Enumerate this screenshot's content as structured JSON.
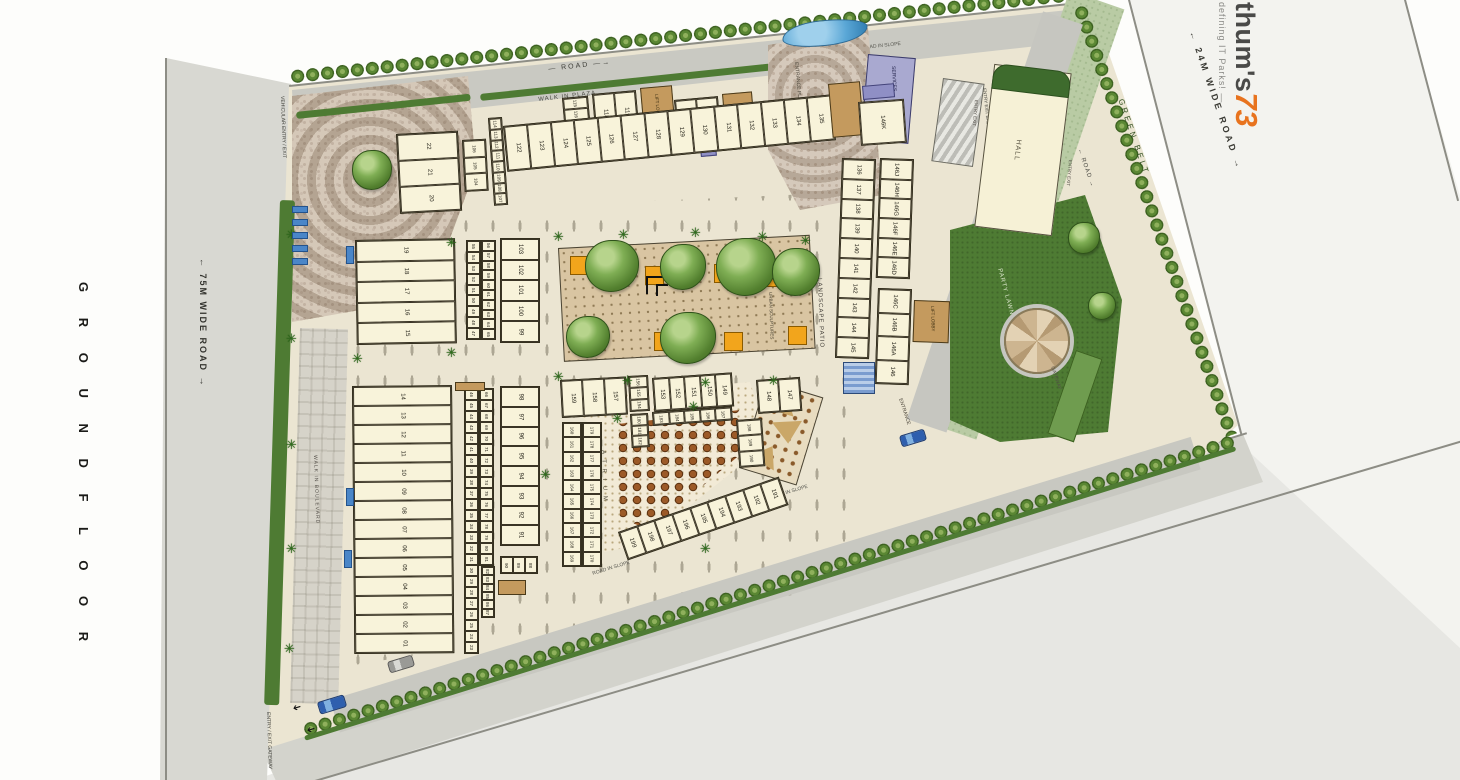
{
  "page": {
    "floor_title": "G R O U N D   F L O O R"
  },
  "brand": {
    "name_prefix": "thum's",
    "name_number": "73",
    "tagline": "defining IT Parks! —",
    "accent": "#e8731e"
  },
  "roads": {
    "left": "← 75M WIDE ROAD →",
    "right": "← 24M WIDE ROAD →",
    "bottom": "12M WIDE ROAD →",
    "top_inner": "— ROAD —→",
    "right_inner": "← ROAD →",
    "slope": "ROAD IN SLOPE",
    "green_belt": "GREEN BELT"
  },
  "labels": {
    "walk_in_plaza": "WALK IN PLAZA",
    "walk_in_boulevard": "WALK IN BOULEVARD",
    "patio": "PATIO",
    "vehicular_entry_exit": "VEHICULAR ENTRY / EXIT",
    "entry_exit_gateway": "ENTRY / EXIT GATEWAY",
    "entrance": "ENTRANCE",
    "entrance_plaza": "ENTRANCE PLAZA",
    "entry_exit_basement": "ENTRY EXIT BASEMENT",
    "entry_exit": "ENTRY EXIT",
    "services": "SERVICES",
    "hall": "HALL",
    "party_lawn": "PARTY LAWN",
    "landscape_patio": "LANDSCAPE PATIO",
    "urban_sculptures": "URBAN SCULPTURES",
    "atrium": "A T R I U M",
    "lift_lobby": "LIFT LOBBY",
    "gateway": "GATEWAY"
  },
  "units": {
    "col_22_20": [
      "22",
      "21",
      "20"
    ],
    "col_19_15": [
      "19",
      "18",
      "17",
      "16",
      "15"
    ],
    "col_14_01": [
      "14",
      "13",
      "12",
      "11",
      "10",
      "09",
      "08",
      "07",
      "06",
      "05",
      "04",
      "03",
      "02",
      "01"
    ],
    "strip_55_47": [
      "55",
      "54",
      "53",
      "52",
      "51",
      "50",
      "49",
      "48",
      "47"
    ],
    "strip_56_65": [
      "56",
      "57",
      "58",
      "59",
      "60",
      "61",
      "62",
      "63",
      "64",
      "65"
    ],
    "strip_46_23": [
      "46",
      "45",
      "44",
      "43",
      "42",
      "41",
      "40",
      "39",
      "38",
      "37",
      "36",
      "35",
      "34",
      "33",
      "32",
      "31",
      "30",
      "29",
      "28",
      "27",
      "26",
      "25",
      "24",
      "23"
    ],
    "strip_66_81": [
      "66",
      "67",
      "68",
      "69",
      "70",
      "71",
      "72",
      "73",
      "74",
      "75",
      "76",
      "77",
      "78",
      "79",
      "80",
      "81"
    ],
    "strip_82_87": [
      "82",
      "83",
      "84",
      "85",
      "86",
      "87"
    ],
    "col_103_99": [
      "103",
      "102",
      "101",
      "100",
      "99"
    ],
    "col_98_91": [
      "98",
      "97",
      "96",
      "95",
      "94",
      "93",
      "92",
      "91"
    ],
    "row_90_88": [
      "90",
      "89",
      "88"
    ],
    "stack_106_104": [
      "106",
      "105",
      "104"
    ],
    "strip_114_107": [
      "114",
      "113",
      "112",
      "111",
      "110",
      "109",
      "108",
      "107"
    ],
    "stack_115_117": [
      "115",
      "116",
      "117"
    ],
    "pair_118_119": [
      "118",
      "119"
    ],
    "pair_120_121": [
      "120",
      "121"
    ],
    "row_122_135": [
      "122",
      "123",
      "124",
      "125",
      "126",
      "127",
      "128",
      "129",
      "130",
      "131",
      "132",
      "133",
      "134",
      "135"
    ],
    "col_136_145": [
      "136",
      "137",
      "138",
      "139",
      "140",
      "141",
      "142",
      "143",
      "144",
      "145"
    ],
    "cell_146K": "146K",
    "col_146J_146D": [
      "146J",
      "146H",
      "146G",
      "146F",
      "146E",
      "146D"
    ],
    "stack_146C_146": [
      "146C",
      "146B",
      "146A",
      "146"
    ],
    "row_159_157": [
      "159",
      "158",
      "157"
    ],
    "stack_156_154": [
      "156",
      "155",
      "154"
    ],
    "row_153_149": [
      "153",
      "152",
      "151",
      "150",
      "149"
    ],
    "pair_148_147": [
      "148",
      "147"
    ],
    "row_183_187": [
      "183",
      "184",
      "185",
      "186",
      "187"
    ],
    "strip_160_169": [
      "160",
      "161",
      "162",
      "163",
      "164",
      "165",
      "166",
      "167",
      "168",
      "169"
    ],
    "strip_179_170": [
      "179",
      "178",
      "177",
      "176",
      "175",
      "174",
      "173",
      "172",
      "171",
      "170"
    ],
    "stack_180_182": [
      "180",
      "181",
      "182"
    ],
    "col_188_190": [
      "188",
      "189",
      "190"
    ],
    "diag_199_191": [
      "199",
      "198",
      "197",
      "196",
      "195",
      "194",
      "193",
      "192",
      "191"
    ]
  },
  "colors": {
    "site_bg": "#ebe5d2",
    "building": "#f8f3da",
    "road_grey": "#d2d2cb",
    "lawn_green": "#4e7b33",
    "green_belt": "#b9cba4",
    "patio_tan": "#d9c5a2",
    "planter_orange": "#f2a51c",
    "services_purple": "#a9a9d0",
    "water_blue": "#5aa7d6",
    "table_brown": "#8a4f20",
    "brand_orange": "#e8731e"
  }
}
